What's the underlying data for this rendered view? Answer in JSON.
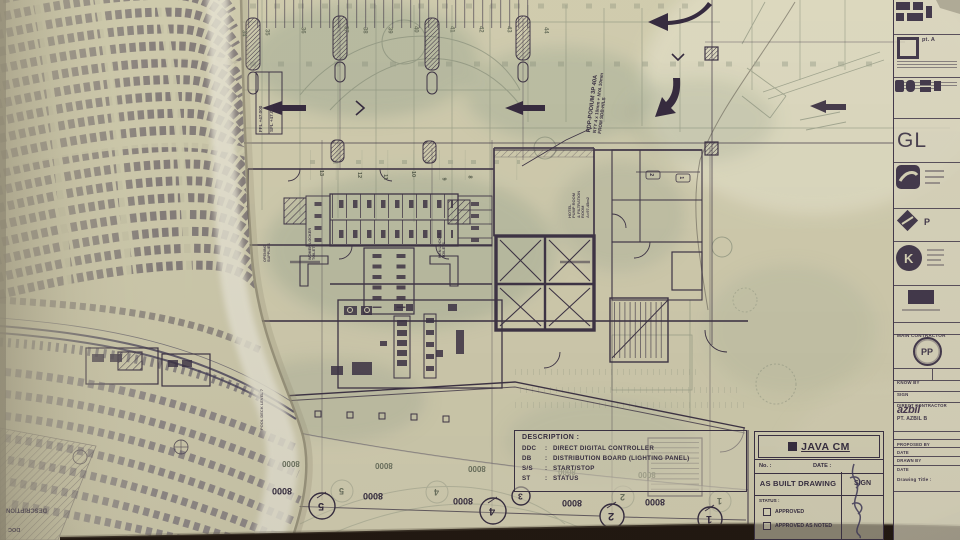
{
  "description_box": {
    "title": "DESCRIPTION :",
    "colon": ":",
    "entries": [
      {
        "abbr": "DDC",
        "meaning": "DIRECT DIGITAL CONTROLLER"
      },
      {
        "abbr": "DB",
        "meaning": "DISTRIBUTION BOARD (LIGHTING PANEL)"
      },
      {
        "abbr": "S/S",
        "meaning": "START/STOP"
      },
      {
        "abbr": "ST",
        "meaning": "STATUS"
      }
    ]
  },
  "title_block": {
    "company": "JAVA CM",
    "no_label": "No. :",
    "date_label": "DATE :",
    "drawing_type": "AS BUILT DRAWING",
    "sign_label": "SIGN",
    "status_label": "STATUS :",
    "approved": "APPROVED",
    "approved_as_noted": "APPROVED AS NOTED"
  },
  "right_strip": {
    "pt_a": "pt. A",
    "gl_logo": "GL",
    "diamond_p": "P",
    "main_contractor": "MAIN CONTRACTOR",
    "pp_logo": "PP",
    "know_by": "KNOW BY",
    "sign": "SIGN",
    "direct_contractor": "DIRECT CONTRACTOR",
    "azbil": "azbil",
    "azbil_company": "PT. AZBIL B",
    "proposed_by": "PROPOSED BY",
    "date1": "DATE",
    "drawn_by": "DRAWN BY",
    "date2": "DATE",
    "drawing_title": "Drawing Title :"
  },
  "plan": {
    "pdp_line1": "PDP-PODIUM 3P 40A",
    "pdp_line2": "NYY 4 x 10mm + NYA 10mm",
    "pdp_line3": "FROM SDB-H/LS",
    "pump_room_l1": "HOTEL",
    "pump_room_l2": "PUMP ROOM",
    "pump_room_l3": "& FILTRATION",
    "pump_room_l4": "ROOM",
    "pump_room_l5": "A=97.45m2",
    "women_locker": "WOMEN LOCKER",
    "toilets_a": "TOILETS",
    "men_locker": "MEN LOCKER",
    "toilets_b": "TOILETS",
    "supplies_l1": "OPENING",
    "supplies_l2": "SUPPLIES",
    "pool_deck": "POOL DECK LEVEL 7",
    "ffl": "FFL +47.000",
    "sfl": "SFL +47.000",
    "mirror_description": "DESCRIPTION",
    "mirror_doc": "DOC"
  },
  "grid": {
    "bubbles": [
      "5",
      "4",
      "3",
      "2",
      "1"
    ],
    "dim": "8000",
    "top_numbers": [
      "34",
      "35",
      "36",
      "37",
      "38",
      "39",
      "40",
      "41",
      "42",
      "43",
      "44"
    ],
    "mid_numbers": [
      "13",
      "12",
      "11",
      "10",
      "9",
      "8"
    ],
    "cell_tags": [
      "2",
      "1"
    ]
  },
  "colors": {
    "paper": "#d7d3b5",
    "paper_light": "#eeeadc",
    "underlay_green": "#a9b39b",
    "ink": "#3e3447",
    "ink_bold": "#352a40",
    "table_dark": "#211811"
  }
}
